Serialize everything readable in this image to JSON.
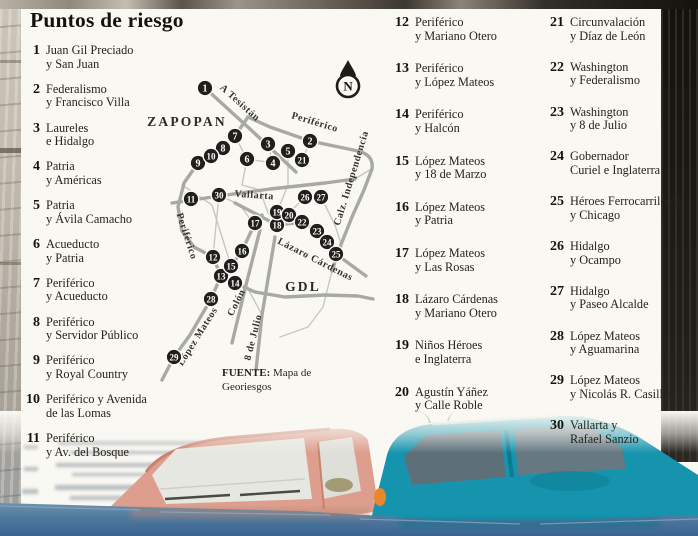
{
  "title": "Puntos de riesgo",
  "list": {
    "columns": [
      {
        "items": [
          {
            "n": "1",
            "lines": [
              "Juan Gil Preciado",
              "y San Juan"
            ]
          },
          {
            "n": "2",
            "lines": [
              "Federalismo",
              "y Francisco Villa"
            ]
          },
          {
            "n": "3",
            "lines": [
              "Laureles",
              "e Hidalgo"
            ]
          },
          {
            "n": "4",
            "lines": [
              "Patria",
              "y Américas"
            ]
          },
          {
            "n": "5",
            "lines": [
              "Patria",
              "y Ávila Camacho"
            ]
          },
          {
            "n": "6",
            "lines": [
              "Acueducto",
              "y Patria"
            ]
          },
          {
            "n": "7",
            "lines": [
              "Periférico",
              "y Acueducto"
            ]
          },
          {
            "n": "8",
            "lines": [
              "Periférico",
              "y Servidor Público"
            ]
          },
          {
            "n": "9",
            "lines": [
              "Periférico",
              "y Royal Country"
            ]
          },
          {
            "n": "10",
            "lines": [
              "Periférico y Avenida",
              "de las Lomas"
            ]
          },
          {
            "n": "11",
            "lines": [
              "Periférico",
              "y Av. del Bosque"
            ]
          }
        ]
      },
      {
        "items": [
          {
            "n": "12",
            "lines": [
              "Periférico",
              "y Mariano Otero"
            ]
          },
          {
            "n": "13",
            "lines": [
              "Periférico",
              "y López Mateos"
            ]
          },
          {
            "n": "14",
            "lines": [
              "Periférico",
              "y Halcón"
            ]
          },
          {
            "n": "15",
            "lines": [
              "López Mateos",
              "y 18 de Marzo"
            ]
          },
          {
            "n": "16",
            "lines": [
              "López Mateos",
              "y Patria"
            ]
          },
          {
            "n": "17",
            "lines": [
              "López Mateos",
              "y Las Rosas"
            ]
          },
          {
            "n": "18",
            "lines": [
              "Lázaro Cárdenas",
              "y Mariano Otero"
            ]
          },
          {
            "n": "19",
            "lines": [
              "Niños Héroes",
              "e Inglaterra"
            ]
          },
          {
            "n": "20",
            "lines": [
              "Agustín Yáñez",
              "y Calle Roble"
            ]
          }
        ]
      },
      {
        "items": [
          {
            "n": "21",
            "lines": [
              "Circunvalación",
              "y Díaz de León"
            ]
          },
          {
            "n": "22",
            "lines": [
              "Washington",
              "y Federalismo"
            ]
          },
          {
            "n": "23",
            "lines": [
              "Washington",
              "y 8 de Julio"
            ]
          },
          {
            "n": "24",
            "lines": [
              "Gobernador",
              "Curiel e Inglaterra"
            ]
          },
          {
            "n": "25",
            "lines": [
              "Héroes Ferrocarrileros",
              "y Chicago"
            ]
          },
          {
            "n": "26",
            "lines": [
              "Hidalgo",
              "y Ocampo"
            ]
          },
          {
            "n": "27",
            "lines": [
              "Hidalgo",
              "y Paseo Alcalde"
            ]
          },
          {
            "n": "28",
            "lines": [
              "López Mateos",
              "y Aguamarina"
            ]
          },
          {
            "n": "29",
            "lines": [
              "López Mateos",
              "y Nicolás R. Casillas"
            ]
          },
          {
            "n": "30",
            "lines": [
              "Vallarta y",
              "Rafael Sanzio"
            ]
          }
        ]
      }
    ]
  },
  "map": {
    "compass_label": "N",
    "city_labels": [
      {
        "text": "ZAPOPAN",
        "x": 67,
        "y": 71,
        "rot": 0,
        "cls": "city-label"
      },
      {
        "text": "GDL",
        "x": 183,
        "y": 236,
        "rot": 0,
        "cls": "city-label"
      }
    ],
    "road_labels": [
      {
        "text": "A Tesistán",
        "x": 118,
        "y": 50,
        "rot": 42,
        "cls": "road-label"
      },
      {
        "text": "Periférico",
        "x": 194,
        "y": 70,
        "rot": 17,
        "cls": "road-label"
      },
      {
        "text": "Calz. Independencia",
        "x": 234,
        "y": 124,
        "rot": -73,
        "cls": "road-label"
      },
      {
        "text": "Vallarta",
        "x": 134,
        "y": 143,
        "rot": 4,
        "cls": "road-label"
      },
      {
        "text": "Periférico",
        "x": 64,
        "y": 182,
        "rot": 72,
        "cls": "road-label"
      },
      {
        "text": "Lázaro Cárdenas",
        "x": 194,
        "y": 207,
        "rot": 27,
        "cls": "road-label"
      },
      {
        "text": "Colón",
        "x": 119,
        "y": 249,
        "rot": -63,
        "cls": "road-label"
      },
      {
        "text": "8 de Julio",
        "x": 136,
        "y": 283,
        "rot": -76,
        "cls": "road-label"
      },
      {
        "text": "López Mateos",
        "x": 80,
        "y": 283,
        "rot": -58,
        "cls": "road-label"
      }
    ],
    "markers": [
      {
        "n": "1",
        "x": 85,
        "y": 33
      },
      {
        "n": "2",
        "x": 190,
        "y": 86
      },
      {
        "n": "3",
        "x": 148,
        "y": 89
      },
      {
        "n": "4",
        "x": 153,
        "y": 108
      },
      {
        "n": "5",
        "x": 168,
        "y": 96
      },
      {
        "n": "6",
        "x": 127,
        "y": 104
      },
      {
        "n": "7",
        "x": 115,
        "y": 81
      },
      {
        "n": "8",
        "x": 103,
        "y": 93
      },
      {
        "n": "9",
        "x": 78,
        "y": 108
      },
      {
        "n": "10",
        "x": 91,
        "y": 101
      },
      {
        "n": "11",
        "x": 71,
        "y": 144
      },
      {
        "n": "12",
        "x": 93,
        "y": 202
      },
      {
        "n": "13",
        "x": 101,
        "y": 221
      },
      {
        "n": "14",
        "x": 115,
        "y": 228
      },
      {
        "n": "15",
        "x": 111,
        "y": 211
      },
      {
        "n": "16",
        "x": 122,
        "y": 196
      },
      {
        "n": "17",
        "x": 135,
        "y": 168
      },
      {
        "n": "18",
        "x": 157,
        "y": 170
      },
      {
        "n": "19",
        "x": 157,
        "y": 157
      },
      {
        "n": "20",
        "x": 169,
        "y": 160
      },
      {
        "n": "21",
        "x": 182,
        "y": 105
      },
      {
        "n": "22",
        "x": 182,
        "y": 167
      },
      {
        "n": "23",
        "x": 197,
        "y": 176
      },
      {
        "n": "24",
        "x": 207,
        "y": 187
      },
      {
        "n": "25",
        "x": 216,
        "y": 199
      },
      {
        "n": "26",
        "x": 185,
        "y": 142
      },
      {
        "n": "27",
        "x": 201,
        "y": 142
      },
      {
        "n": "28",
        "x": 91,
        "y": 244
      },
      {
        "n": "29",
        "x": 54,
        "y": 302
      },
      {
        "n": "30",
        "x": 99,
        "y": 140
      }
    ],
    "source": {
      "bold": "FUENTE:",
      "line1_rest": " Mapa de",
      "line2": "Georiesgos"
    }
  },
  "colors": {
    "marker": "#201f1b",
    "road": "#a9a9a4",
    "water": "#4d7ba1",
    "car_salmon": "#dd9e8d",
    "car_teal": "#1694ae",
    "panel": "#f9f8f3"
  }
}
